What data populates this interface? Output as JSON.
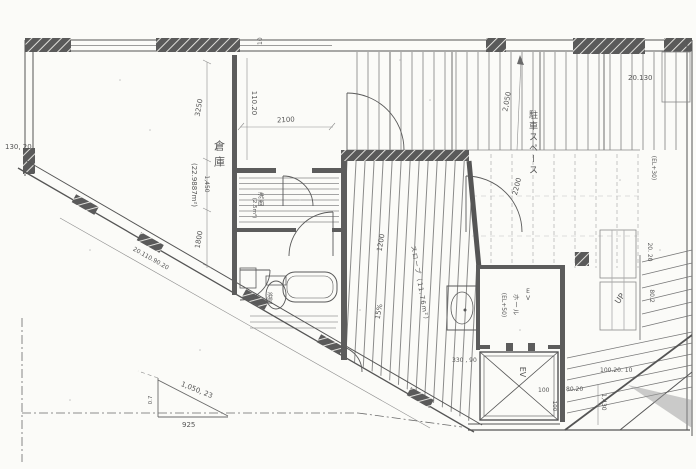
{
  "drawing": {
    "kind": "floor-plan-scan",
    "rooms": {
      "warehouse": {
        "name": "倉庫",
        "area": "(22.9887m²)"
      },
      "slope": {
        "name": "スロープ（11.76m²）",
        "grade": "15%"
      },
      "parking": {
        "name": "駐車スペース",
        "level": "(EL+30)"
      },
      "ev_hall": {
        "name": "ホール",
        "level": "(EL+50)",
        "ev": "EV"
      },
      "elevator": {
        "label": "EV"
      },
      "washroom": {
        "name": "洗面",
        "area": "(2.5m²)"
      },
      "bath": {
        "name": "浴室"
      },
      "stairs": {
        "up": "UP"
      }
    },
    "dimensions": {
      "top_10": "10",
      "v110_20": "110.20",
      "w2100": "2100",
      "v3250": "3250",
      "v1450": "1,450",
      "left_130_20": "130, 20",
      "v1800": "1800",
      "diag_seq": "20.110.90.20",
      "v2050": "2,050",
      "tr_20130": "20.130",
      "v2200": "2200",
      "v1200": "1200",
      "r20_20": "20. 20",
      "r80_2": "80.2",
      "b330_90": "330 , 90",
      "b100": "100",
      "b80_20": "80.20",
      "v1430": "1,430",
      "b100_20_10": "100.20. 10",
      "v100": "100",
      "t1050_23": "1,050, 23",
      "t925": "925",
      "t0_7": "0.7"
    },
    "colors": {
      "ink": "#4f4f4f",
      "paper": "#fbfbf8",
      "hatch": "#909090"
    }
  }
}
